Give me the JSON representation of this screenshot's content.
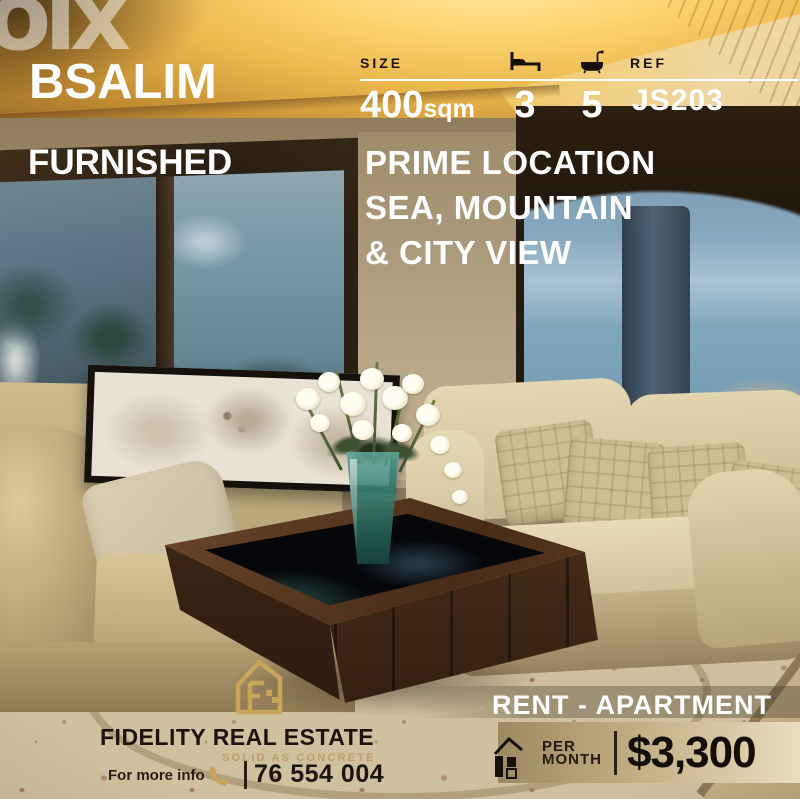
{
  "watermark": {
    "text": "olx",
    "icon": "olx-logo"
  },
  "header": {
    "location": "BSALIM",
    "furnished": "FURNISHED"
  },
  "specs": {
    "size_label": "SIZE",
    "size_value": "400",
    "size_unit": "sqm",
    "bed_icon": "bed-icon",
    "bedrooms": "3",
    "bath_icon": "bath-icon",
    "bathrooms": "5",
    "ref_label": "REF",
    "ref_value": "JS203"
  },
  "highlight": {
    "line1": "PRIME LOCATION",
    "line2": "SEA, MOUNTAIN",
    "line3": "& CITY VIEW"
  },
  "listing": {
    "type": "RENT - APARTMENT"
  },
  "price": {
    "icon": "house-icon",
    "period_line1": "PER",
    "period_line2": "MONTH",
    "amount": "$3,300"
  },
  "agency": {
    "logo_icon": "fidelity-house-logo",
    "name": "FIDELITY REAL ESTATE",
    "tagline": "SOLID AS CONCRETE",
    "info_label": "For more info",
    "phone_icon": "phone-icon",
    "phone": "76 554 004"
  },
  "colors": {
    "accent_gold": "#C9A55C",
    "price_band_left": "#9D8861",
    "price_band_right": "#E9DEC0",
    "text_dark": "#1D150D",
    "text_white": "#FFFFFF",
    "price_text": "#140E08"
  }
}
